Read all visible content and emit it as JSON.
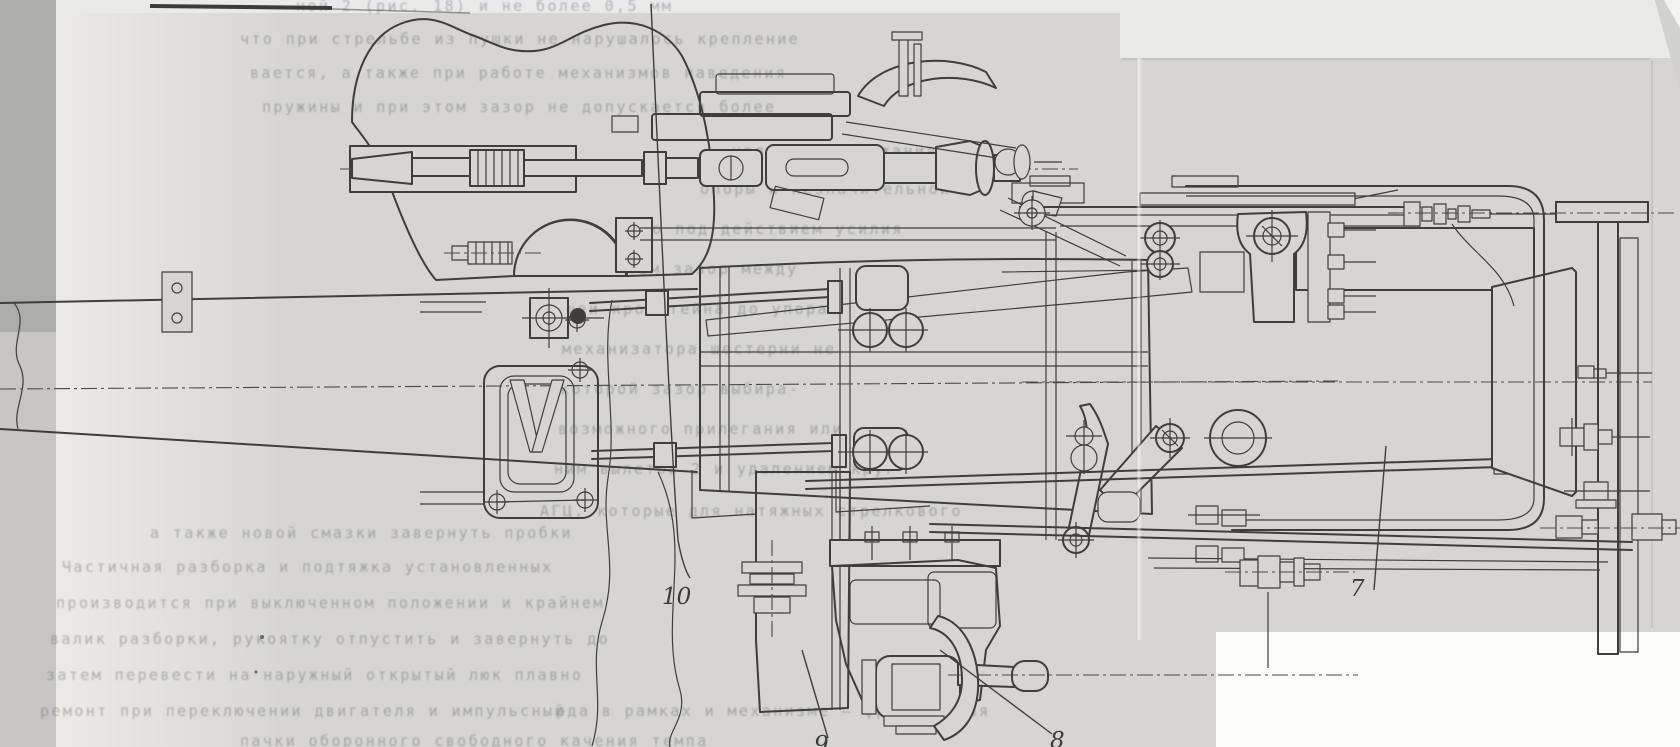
{
  "document": {
    "kind": "scanned-technical-drawing",
    "language": "Russian",
    "description": "Longitudinal cross-section machine drawing of a mechanism assembly on a folded scanned sheet with print-through text from the reverse side"
  },
  "figure": {
    "callouts": [
      {
        "label": "7"
      },
      {
        "label": "8"
      },
      {
        "label": "9"
      },
      {
        "label": "10"
      }
    ]
  },
  "colors": {
    "paper": "#d6d5d0",
    "outside_scan": "#eaeae9",
    "scanner_strip_dark": "#adadac",
    "scanner_strip_light": "#c7c6c4",
    "cutout_white": "#fbfbfa",
    "ink": "#3f3e3c",
    "bleed_text": "#585d66"
  },
  "bleed_text_lines": [
    {
      "text": "ной 2 (рис. 18) и не более 0,5 мм"
    },
    {
      "text": "что при стрельбе из пушки не нарушалось крепление"
    },
    {
      "text": "вается, а также при работе механизмов наведения"
    },
    {
      "text": "пружины и при этом зазор не допускается более"
    },
    {
      "text": "узла для удержания на-"
    },
    {
      "text": "опоры и незначительной"
    },
    {
      "text": "вело под действием усилия"
    },
    {
      "text": "при этом зазор между"
    },
    {
      "text": "щей кронштейна до упора"
    },
    {
      "text": "механизатора шестерни не"
    },
    {
      "text": "которой зазор выбира-"
    },
    {
      "text": "возможного прилегания или"
    },
    {
      "text": "ним вылетов 2 и удалением круг"
    },
    {
      "text": "АГЦ, которые для натяжных стрелкового"
    },
    {
      "text": "а также новой смазки завернуть пробки"
    },
    {
      "text": "Частичная разборка и подтяжка установленных"
    },
    {
      "text": "производится при выключенном положении и крайнем"
    },
    {
      "text": "валик разборки, рукоятку отпустить и завернуть до"
    },
    {
      "text": "затем перевести на наружный открытый люк плавно"
    },
    {
      "text": "ремонт при переключении двигателя и импульсный"
    },
    {
      "text": "рда в рамках и механизме — фрикционная"
    },
    {
      "text": "пачки оборонного свободного качения темпа"
    }
  ]
}
